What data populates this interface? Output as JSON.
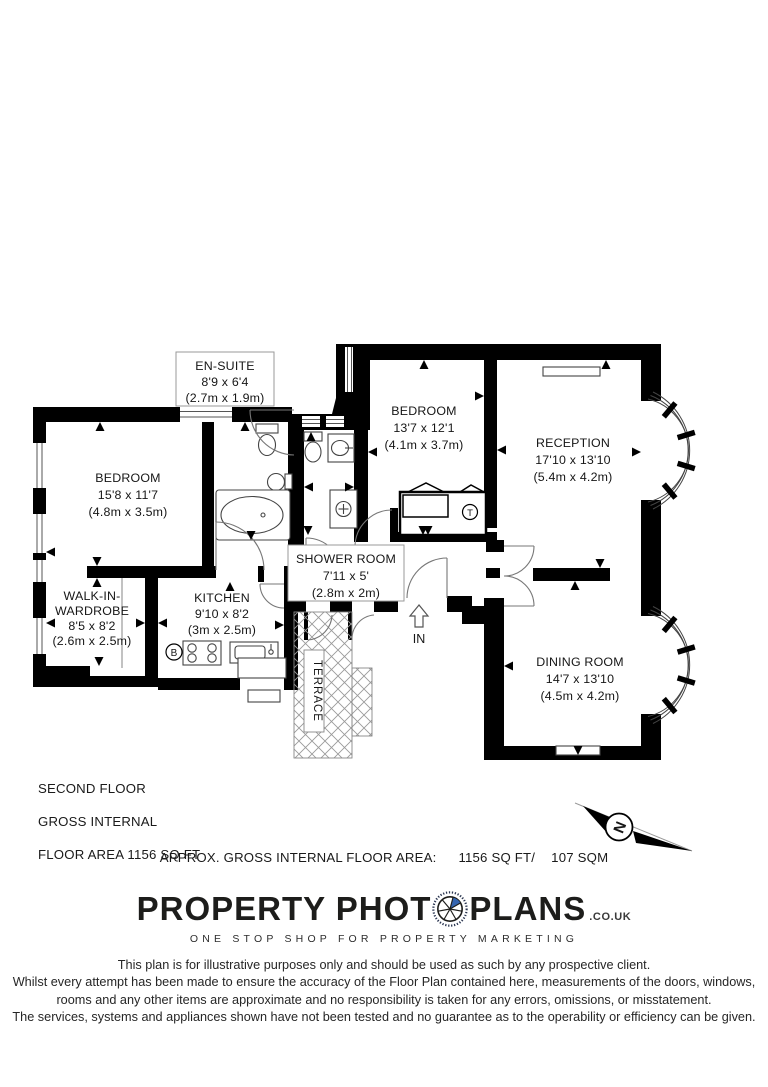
{
  "plan": {
    "floor_info_lines": [
      "SECOND FLOOR",
      "GROSS INTERNAL",
      "FLOOR AREA 1156 SQ FT"
    ],
    "area_summary": {
      "label": "APPROX. GROSS INTERNAL FLOOR AREA:",
      "imperial": "1156 SQ FT/",
      "metric": "107 SQM"
    },
    "entrance_label": "IN",
    "compass_north": "N",
    "terrace_label": "TERRACE",
    "fixtures": {
      "boiler": "B",
      "tank": "T"
    },
    "rooms": [
      {
        "name": "EN-SUITE",
        "dim_imperial": "8'9 x 6'4",
        "dim_metric": "(2.7m x 1.9m)"
      },
      {
        "name": "BEDROOM",
        "dim_imperial": "15'8 x 11'7",
        "dim_metric": "(4.8m x 3.5m)"
      },
      {
        "name": "BEDROOM",
        "dim_imperial": "13'7 x 12'1",
        "dim_metric": "(4.1m x 3.7m)"
      },
      {
        "name": "RECEPTION",
        "dim_imperial": "17'10 x 13'10",
        "dim_metric": "(5.4m x 4.2m)"
      },
      {
        "name": "SHOWER ROOM",
        "dim_imperial": "7'11 x 5'",
        "dim_metric": "(2.8m x 2m)"
      },
      {
        "name_line1": "WALK-IN-",
        "name_line2": "WARDROBE",
        "dim_imperial": "8'5 x 8'2",
        "dim_metric": "(2.6m x 2.5m)"
      },
      {
        "name": "KITCHEN",
        "dim_imperial": "9'10 x 8'2",
        "dim_metric": "(3m x 2.5m)"
      },
      {
        "name": "DINING ROOM",
        "dim_imperial": "14'7 x 13'10",
        "dim_metric": "(4.5m x 4.2m)"
      }
    ]
  },
  "branding": {
    "logo_text_1": "PROPERTY PHOT",
    "logo_text_2": "PLANS",
    "logo_suffix": ".CO.UK",
    "tagline": "ONE STOP SHOP FOR PROPERTY MARKETING"
  },
  "disclaimer_lines": [
    "This plan is for illustrative purposes only and should be used as such by any prospective client.",
    "Whilst every attempt has been made to ensure the accuracy of the Floor Plan contained here, measurements of the doors, windows,",
    "rooms and any other items are approximate and no responsibility is taken for any errors, omissions, or misstatement.",
    "The services, systems and appliances shown have not been tested and no guarantee as to the operability or efficiency can be given."
  ],
  "colors": {
    "wall": "#000000",
    "aperture_blue": "#3565b0"
  }
}
